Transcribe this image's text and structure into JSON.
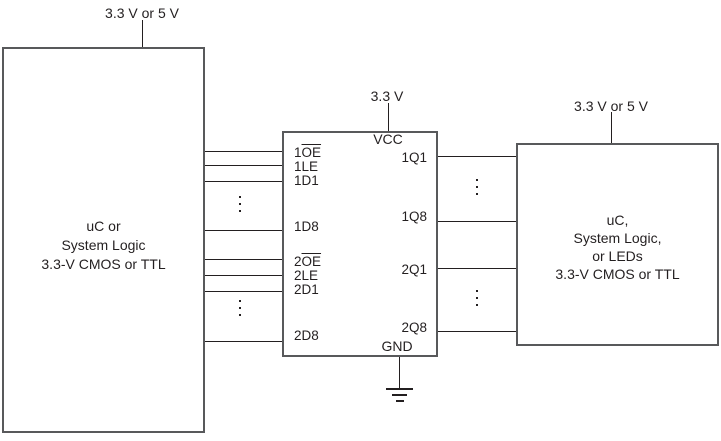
{
  "colors": {
    "box_border": "#58595B",
    "wire": "#231F20",
    "text": "#231F20",
    "background": "#FFFFFF"
  },
  "supplies": {
    "left": "3.3 V or 5 V",
    "middle": "3.3 V",
    "right": "3.3 V or 5 V"
  },
  "left_box": {
    "line1": "uC or",
    "line2": "System Logic",
    "line3": "3.3-V CMOS or TTL"
  },
  "ic": {
    "vcc": "VCC",
    "gnd": "GND",
    "left_pins": [
      {
        "pre": "1",
        "over": "OE"
      },
      {
        "pre": "1LE"
      },
      {
        "pre": "1D1"
      },
      {
        "pre": "1D8"
      },
      {
        "pre": "2",
        "over": "OE"
      },
      {
        "pre": "2LE"
      },
      {
        "pre": "2D1"
      },
      {
        "pre": "2D8"
      }
    ],
    "right_pins": [
      "1Q1",
      "1Q8",
      "2Q1",
      "2Q8"
    ]
  },
  "right_box": {
    "line1": "uC,",
    "line2": "System Logic,",
    "line3": "or LEDs",
    "line4": "3.3-V CMOS or TTL"
  }
}
